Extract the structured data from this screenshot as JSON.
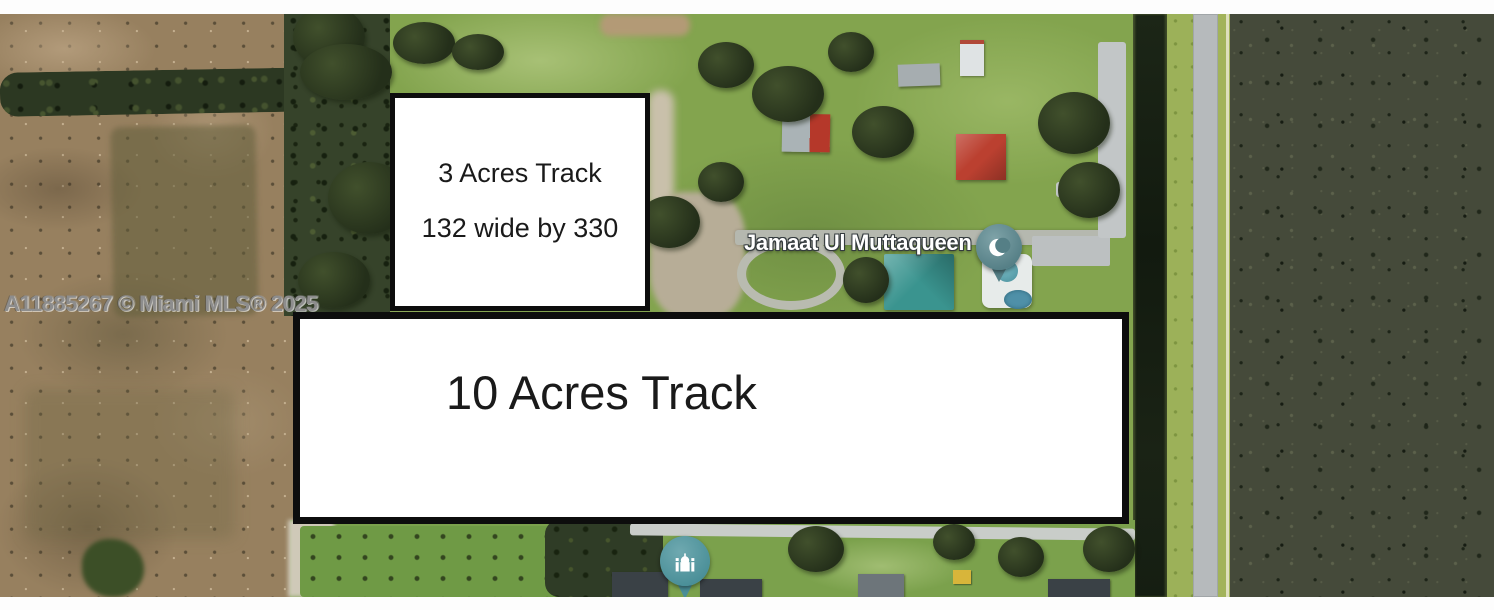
{
  "photo": {
    "watermark": "A11885267 © Miami MLS® 2025",
    "place_label": "Jamaat Ul Muttaqueen"
  },
  "tracts": {
    "three_acre": {
      "title": "3 Acres Track",
      "dimensions": "132 wide by 330"
    },
    "ten_acre": {
      "title": "10 Acres Track"
    }
  },
  "map_pins": [
    {
      "name": "mosque-location-pin",
      "icon": "crescent-moon-icon",
      "color": "#557f86"
    },
    {
      "name": "place-of-worship-pin",
      "icon": "mosque-building-icon",
      "color": "#4a8f98"
    }
  ],
  "colors": {
    "box_border": "#0d0d0d",
    "box_fill": "#ffffff",
    "watermark_gray": "#8d8d8d",
    "label_white": "#ffffff",
    "grass_green": "#83a44e",
    "dirt_brown": "#97805f",
    "forest_dark": "#454a3a",
    "canal_dark": "#131a10",
    "road_gray": "#b6babc",
    "red_roof": "#bb4030",
    "teal_roof": "#3a948f",
    "pin_teal": "#4a8f98"
  }
}
